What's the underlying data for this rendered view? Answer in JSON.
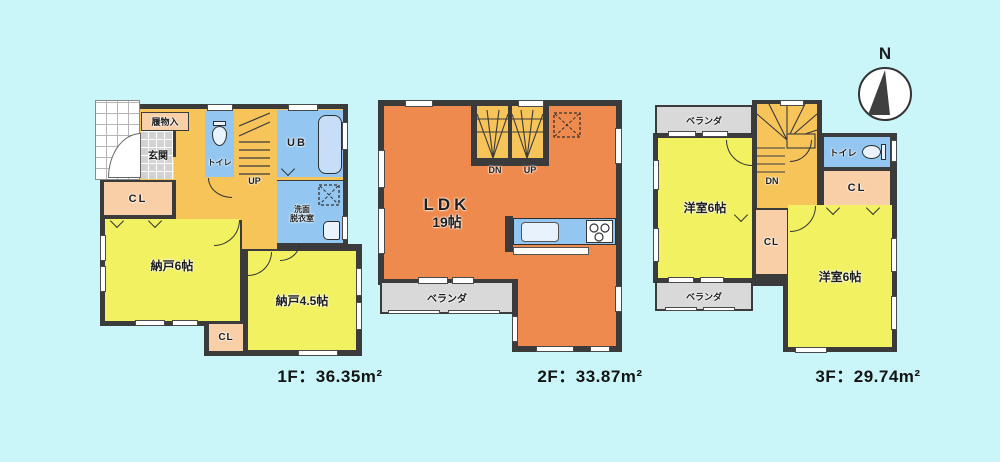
{
  "colors": {
    "background": "#cbf6f9",
    "wall": "#3b3b3b",
    "room_yellow": "#f1f162",
    "ldk_orange": "#ef8a4e",
    "hall_amber": "#f7c45a",
    "water_blue": "#93c7f1",
    "closet_peach": "#f8cfa6",
    "veranda_gray": "#d9d9d9"
  },
  "compass": {
    "north_label": "N"
  },
  "floor1": {
    "area_label": "1F：36.35m²",
    "shoe_storage": "履物入",
    "entrance": "玄関",
    "toilet": "トイレ",
    "stairs_up": "UP",
    "unit_bath": "UB",
    "washroom_line1": "洗面",
    "washroom_line2": "脱衣室",
    "closet_left": "CL",
    "storage_room_6": "納戸6帖",
    "storage_room_45": "納戸4.5帖",
    "closet_bottom": "CL"
  },
  "floor2": {
    "area_label": "2F：33.87m²",
    "stairs_down": "DN",
    "stairs_up": "UP",
    "ldk_name": "LDK",
    "ldk_size": "19帖",
    "veranda": "ベランダ"
  },
  "floor3": {
    "area_label": "3F：29.74m²",
    "veranda_top": "ベランダ",
    "western_room_left": "洋室6帖",
    "stairs_down": "DN",
    "toilet": "トイレ",
    "closet_upper": "CL",
    "closet_middle": "CL",
    "western_room_right": "洋室6帖",
    "veranda_bottom": "ベランダ"
  }
}
